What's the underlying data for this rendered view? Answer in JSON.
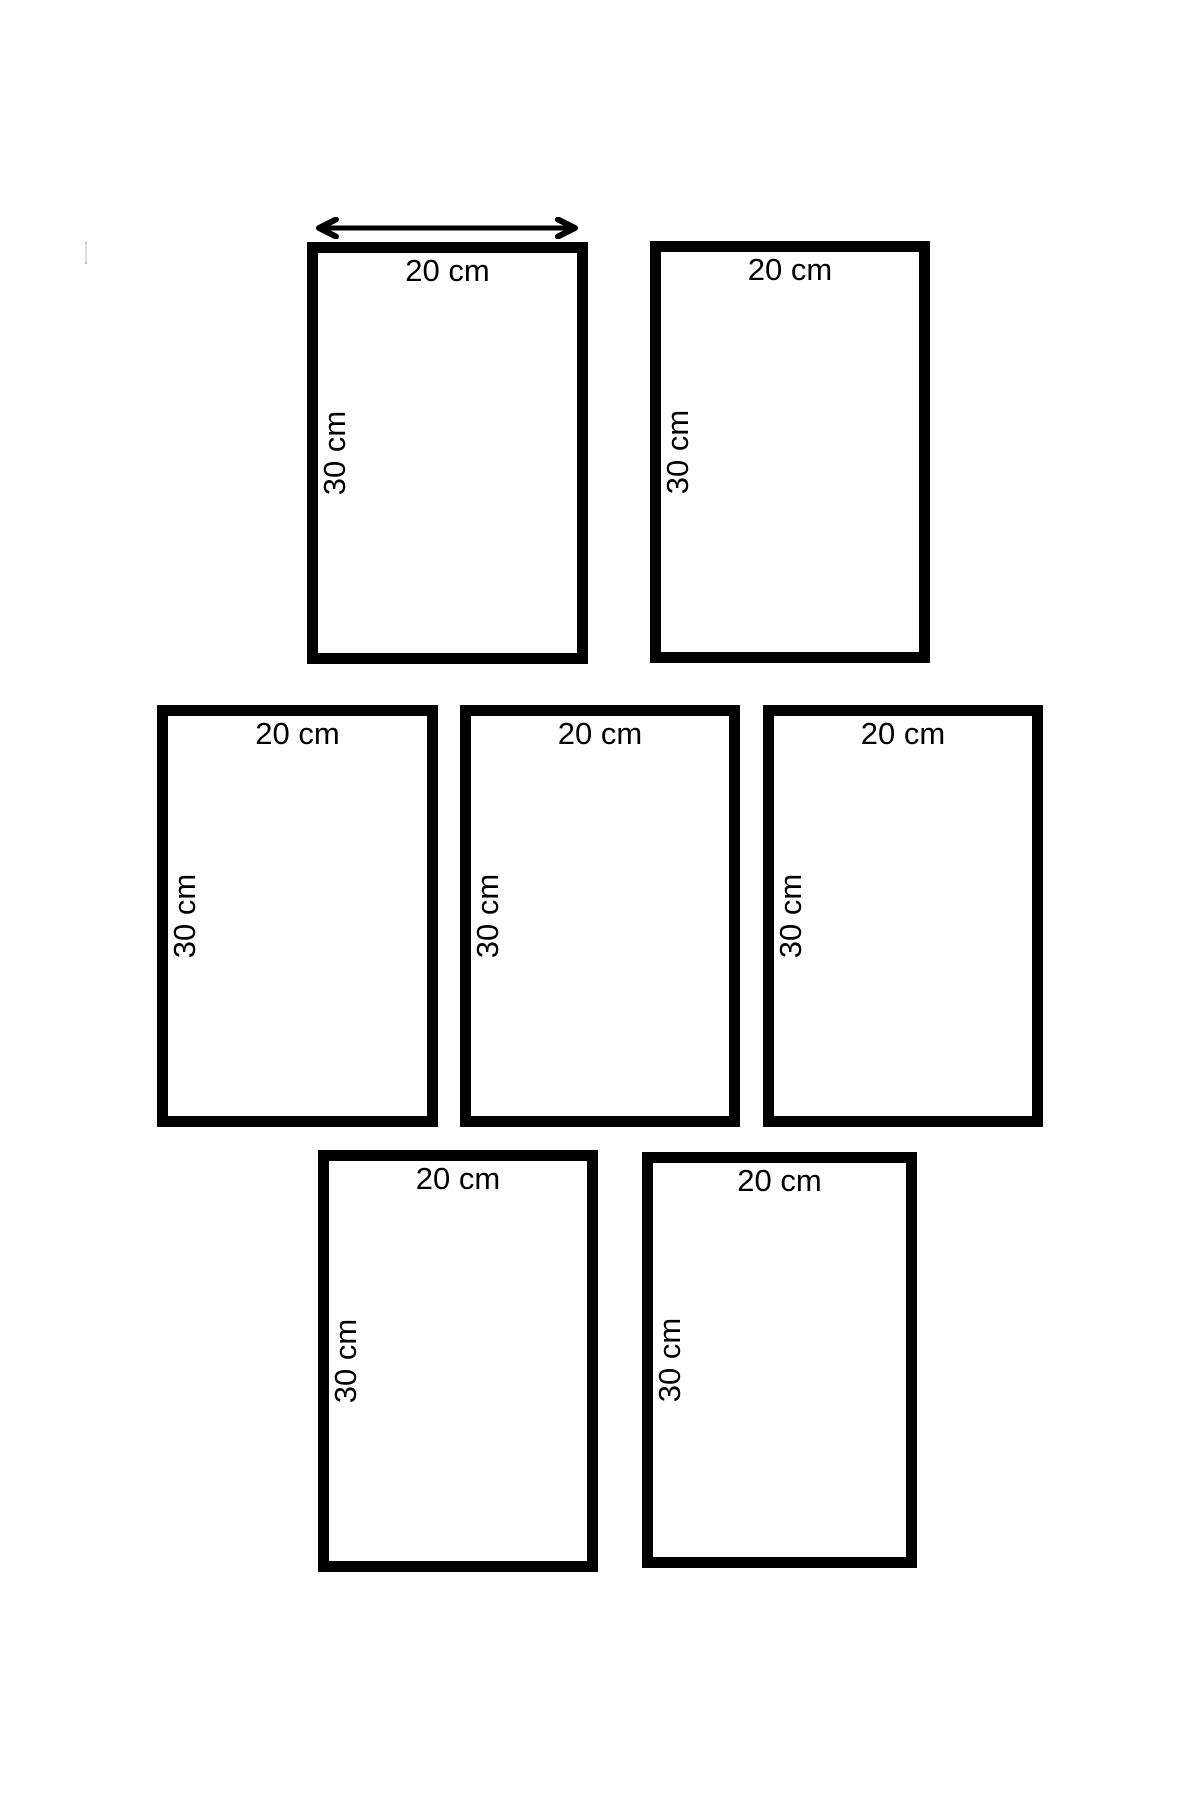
{
  "diagram": {
    "background_color": "#ffffff",
    "line_color": "#000000",
    "rectangles": [
      {
        "id": "top-left",
        "width_label": "20 cm",
        "height_label": "30 cm",
        "has_dimension_arrows": true
      },
      {
        "id": "top-right",
        "width_label": "20 cm",
        "height_label": "30 cm",
        "has_dimension_arrows": false
      },
      {
        "id": "middle-left",
        "width_label": "20 cm",
        "height_label": "30 cm",
        "has_dimension_arrows": false
      },
      {
        "id": "middle-center",
        "width_label": "20 cm",
        "height_label": "30 cm",
        "has_dimension_arrows": false
      },
      {
        "id": "middle-right",
        "width_label": "20 cm",
        "height_label": "30 cm",
        "has_dimension_arrows": false
      },
      {
        "id": "bottom-left",
        "width_label": "20 cm",
        "height_label": "30 cm",
        "has_dimension_arrows": false
      },
      {
        "id": "bottom-right",
        "width_label": "20 cm",
        "height_label": "30 cm",
        "has_dimension_arrows": false
      }
    ],
    "dimension_arrows": {
      "horizontal": {
        "icon": "left-right-arrow-icon",
        "measures": "width",
        "label": "20 cm"
      },
      "vertical": {
        "icon": "up-down-arrow-icon",
        "measures": "height",
        "label": "30 cm"
      }
    }
  }
}
